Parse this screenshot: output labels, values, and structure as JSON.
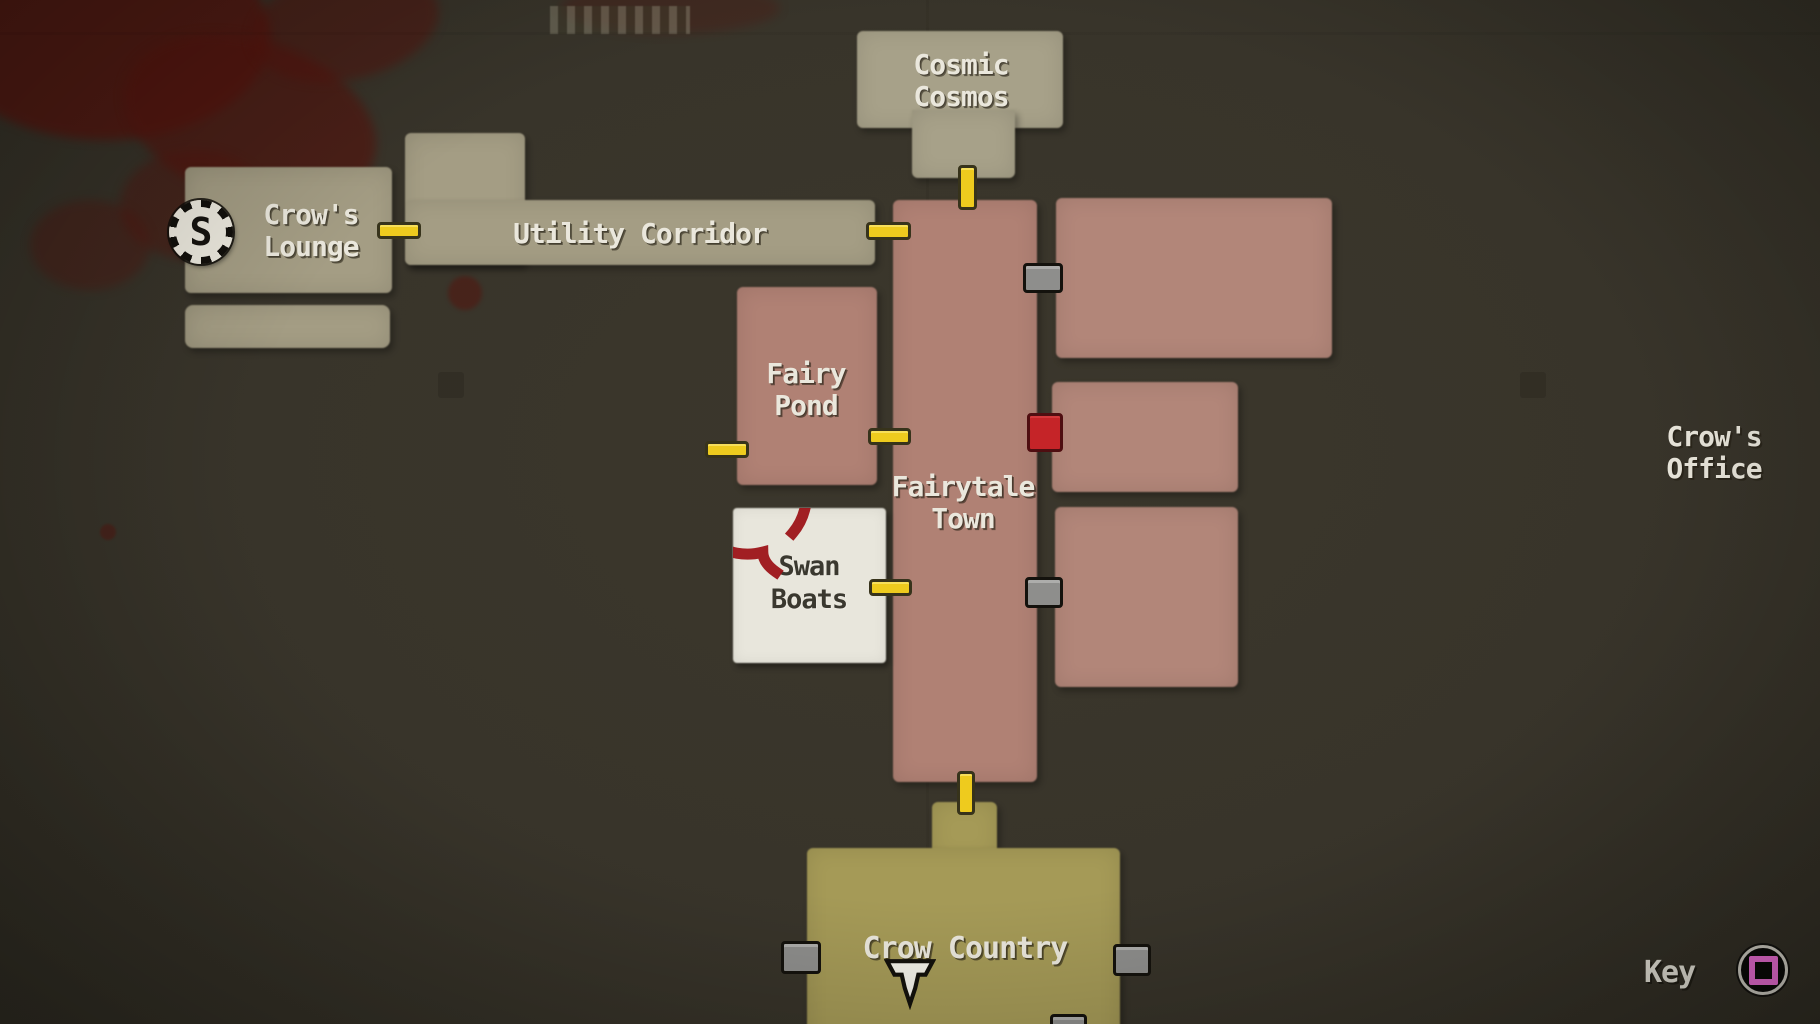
{
  "colors": {
    "background": "#38342a",
    "room_tan": "#a49d84",
    "room_pink": "#b08174",
    "room_gold": "#a59a57",
    "room_white": "#e8e6dc",
    "door_unlocked_yellow": "#eecb1e",
    "door_locked_gray": "#8e8e8c",
    "door_special_red": "#c52428",
    "label_text": "#eae7dc",
    "swan_label_text": "#3a382f",
    "annotation_circle_red": "#9c1116",
    "key_button_pink": "#ee6fd7",
    "blood_stain_red": "#54150e"
  },
  "rooms": {
    "cosmic_cosmos": {
      "line1": "Cosmic",
      "line2": "Cosmos"
    },
    "crows_lounge": {
      "line1": "Crow's",
      "line2": "Lounge"
    },
    "utility_corridor": {
      "label": "Utility Corridor"
    },
    "fairy_pond": {
      "line1": "Fairy",
      "line2": "Pond"
    },
    "fairytale_town": {
      "line1": "Fairytale",
      "line2": "Town"
    },
    "swan_boats": {
      "line1": "Swan",
      "line2": "Boats"
    },
    "crow_country": {
      "label": "Crow Country"
    },
    "crows_office": {
      "line1": "Crow's",
      "line2": "Office"
    }
  },
  "markers": {
    "save_point_letter": "S",
    "player_marker": "down-arrow",
    "annotation": "hand-drawn red circle around Swan Boats"
  },
  "doors": {
    "yellow_unlocked_count": 7,
    "gray_locked_count": 5,
    "red_special_count": 1
  },
  "hud": {
    "key_label": "Key",
    "key_button_icon": "ps-square-button"
  }
}
